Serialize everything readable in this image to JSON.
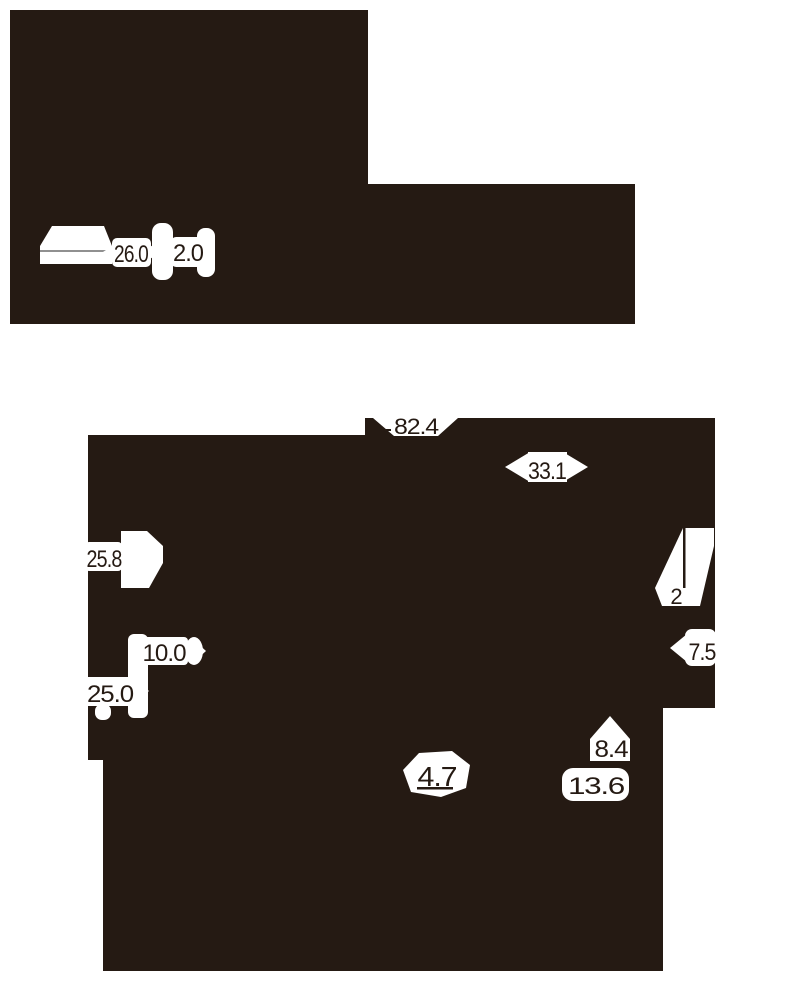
{
  "colors": {
    "ink": "#251a13",
    "paper": "#ffffff",
    "shade": "#909090"
  },
  "views": {
    "top_view": {
      "label": "top-view-silhouette",
      "dims": {
        "length": "26.0",
        "thickness": "2.0"
      }
    },
    "front_view": {
      "label": "front-view-silhouette",
      "dims": {
        "overall_width": "82.4",
        "top_offset": "33.1",
        "upper_left": "25.8",
        "right_gap": "2",
        "right_width": "7.5",
        "pitch": "10.0",
        "lower_left": "25.0",
        "notch": "8.4",
        "bottom_center": "4.7",
        "bottom_right": "13.6"
      }
    }
  }
}
